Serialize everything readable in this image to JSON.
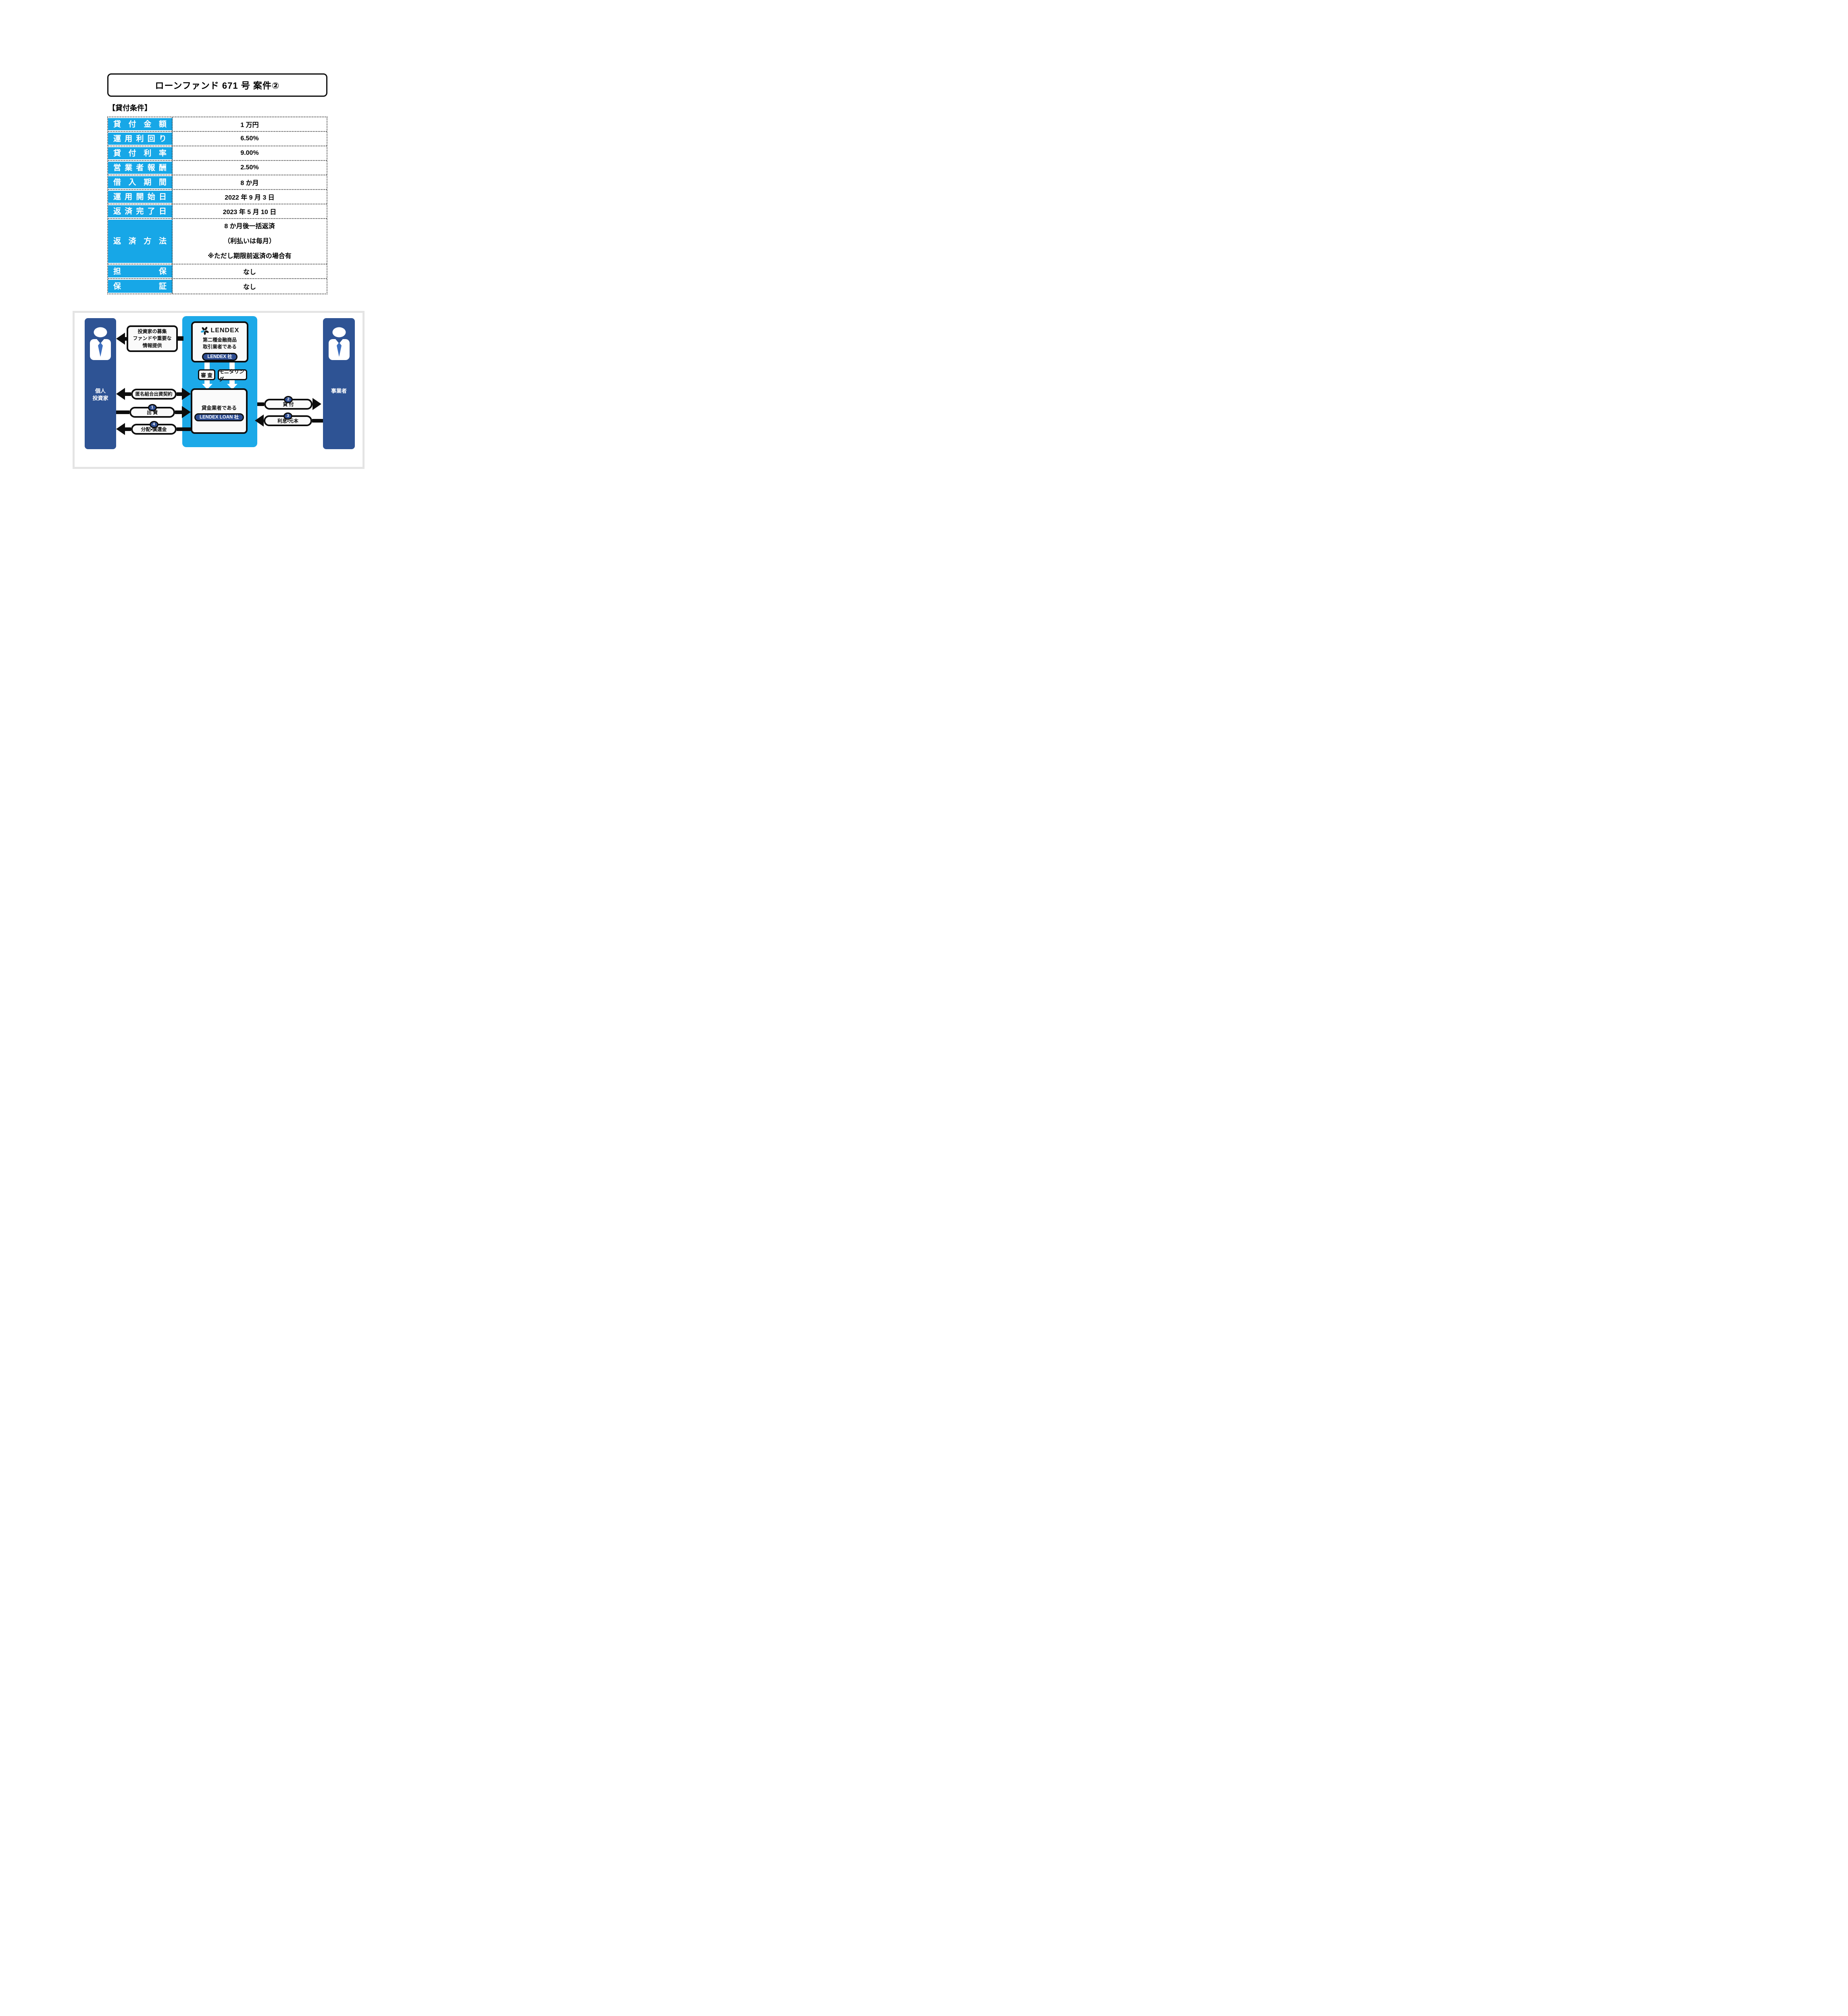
{
  "page": {
    "title": "ローンファンド 671 号 案件②",
    "section_heading": "【貸付条件】"
  },
  "conditions_table": {
    "rows": [
      {
        "label": "貸付金額",
        "value": "1 万円"
      },
      {
        "label": "運用利回り",
        "value": "6.50%"
      },
      {
        "label": "貸付利率",
        "value": "9.00%"
      },
      {
        "label": "営業者報酬",
        "value": "2.50%"
      },
      {
        "label": "借入期間",
        "value": "8 か月"
      },
      {
        "label": "運用開始日",
        "value": "2022 年 9 月 3 日"
      },
      {
        "label": "返済完了日",
        "value": "2023 年 5 月 10 日"
      },
      {
        "label": "返済方法",
        "value_lines": [
          "8 か月後一括返済",
          "（利払いは毎月）",
          "※ただし期限前返済の場合有"
        ]
      },
      {
        "label": "担保",
        "value": "なし"
      },
      {
        "label": "保証",
        "value": "なし"
      }
    ]
  },
  "diagram": {
    "investor_column": {
      "label_lines": [
        "個人",
        "投資家"
      ]
    },
    "business_column": {
      "label": "事業者"
    },
    "lendex_box": {
      "brand": "LENDEX",
      "description_lines": [
        "第二種金融商品",
        "取引業者である"
      ],
      "badge": "LENDEX 社"
    },
    "loan_box": {
      "description": "貸金業者である",
      "badge": "LENDEX LOAN 社"
    },
    "process_labels": {
      "screening": "審 査",
      "monitoring": "モニタリング"
    },
    "flows": {
      "info_box_lines": [
        "投資家の募集",
        "ファンドや重要な",
        "情報提供"
      ],
      "anonymous_contract": "匿名組合出資契約",
      "investment": {
        "number": "1",
        "label": "出 資"
      },
      "loan": {
        "number": "2",
        "label": "貸 付"
      },
      "interest": {
        "number": "3",
        "label": "利息・元本"
      },
      "distribution": {
        "number": "4",
        "label": "分配・償還金"
      }
    },
    "colors": {
      "cyan": "#1ca9e8",
      "table_label_cyan": "#17a7e7",
      "column_navy": "#2e5394",
      "badge_navy": "#2e4d92",
      "border_black": "#0d0d0d",
      "container_border_gray": "#e4e4e4",
      "logo_petal_cyan": "#29abe2"
    }
  }
}
